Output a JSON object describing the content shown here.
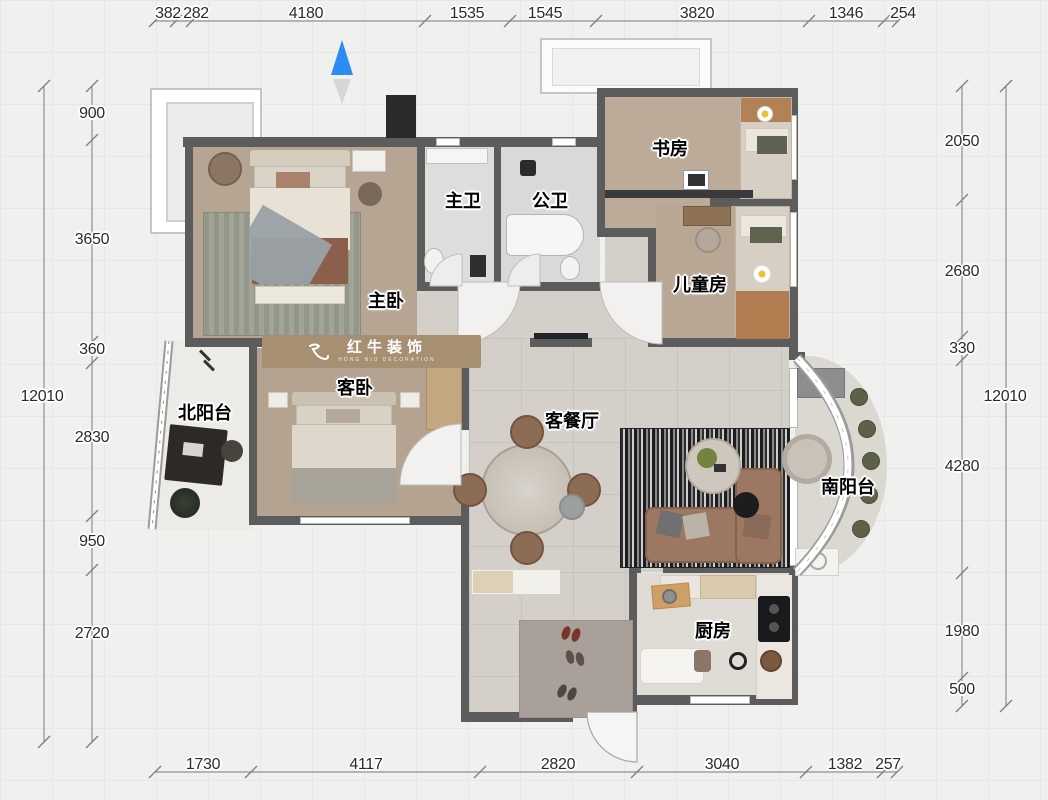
{
  "title_note": "residential floor plan",
  "logo": {
    "name": "红牛装饰",
    "tagline": "HONG NIU DECORATION"
  },
  "rooms": {
    "master_bedroom": "主卧",
    "guest_bedroom": "客卧",
    "master_bath": "主卫",
    "public_bath": "公卫",
    "study": "书房",
    "kids_room": "儿童房",
    "north_balcony": "北阳台",
    "living_dining": "客餐厅",
    "south_balcony": "南阳台",
    "kitchen": "厨房"
  },
  "dimensions": {
    "top": [
      "382",
      "282",
      "4180",
      "1535",
      "1545",
      "3820",
      "1346",
      "254"
    ],
    "bottom": [
      "1730",
      "4117",
      "2820",
      "3040",
      "1382",
      "257"
    ],
    "left": {
      "total": "12010",
      "segments": [
        "900",
        "3650",
        "360",
        "2830",
        "950",
        "2720"
      ]
    },
    "right": {
      "total": "12010",
      "segments": [
        "2050",
        "2680",
        "330",
        "4280",
        "1980",
        "500"
      ]
    }
  },
  "colors": {
    "wall": "#5c5c5c",
    "north_arrow_blue": "#2a8cf4",
    "wood_floor": "#b7a593",
    "tile_floor": "#d4d0c9",
    "logo_plaque": "#a78f72"
  }
}
